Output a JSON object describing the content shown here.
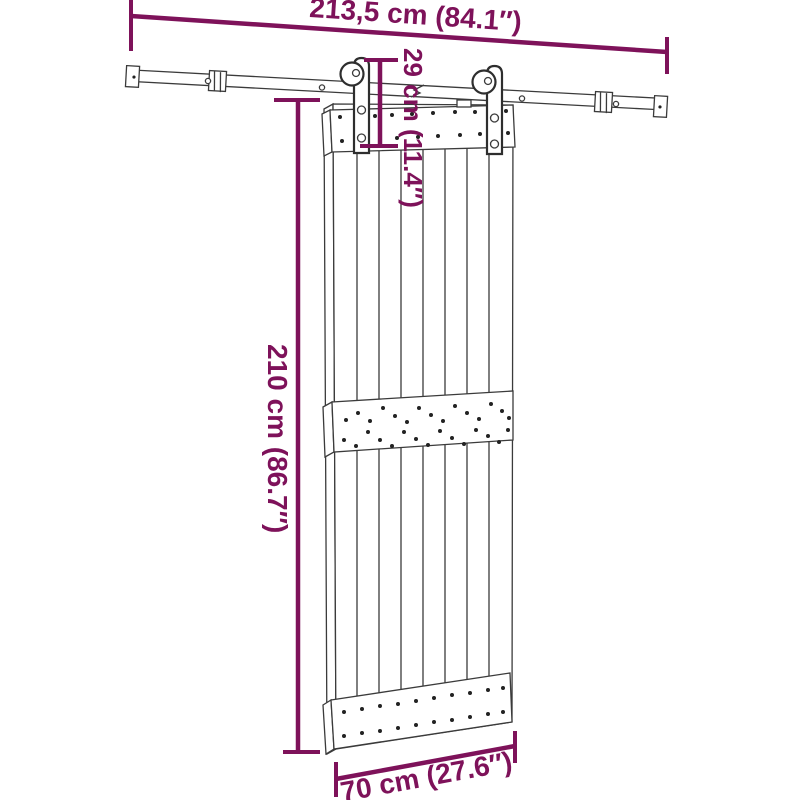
{
  "colors": {
    "dimension": "#7E125A",
    "line": "#3b3b3b",
    "background": "#ffffff"
  },
  "dimensions": {
    "rail_width": "213,5 cm (84.1″)",
    "hanger_height": "29 cm (11.4″)",
    "door_height": "210 cm (86.7″)",
    "door_width": "70 cm (27.6″)"
  }
}
